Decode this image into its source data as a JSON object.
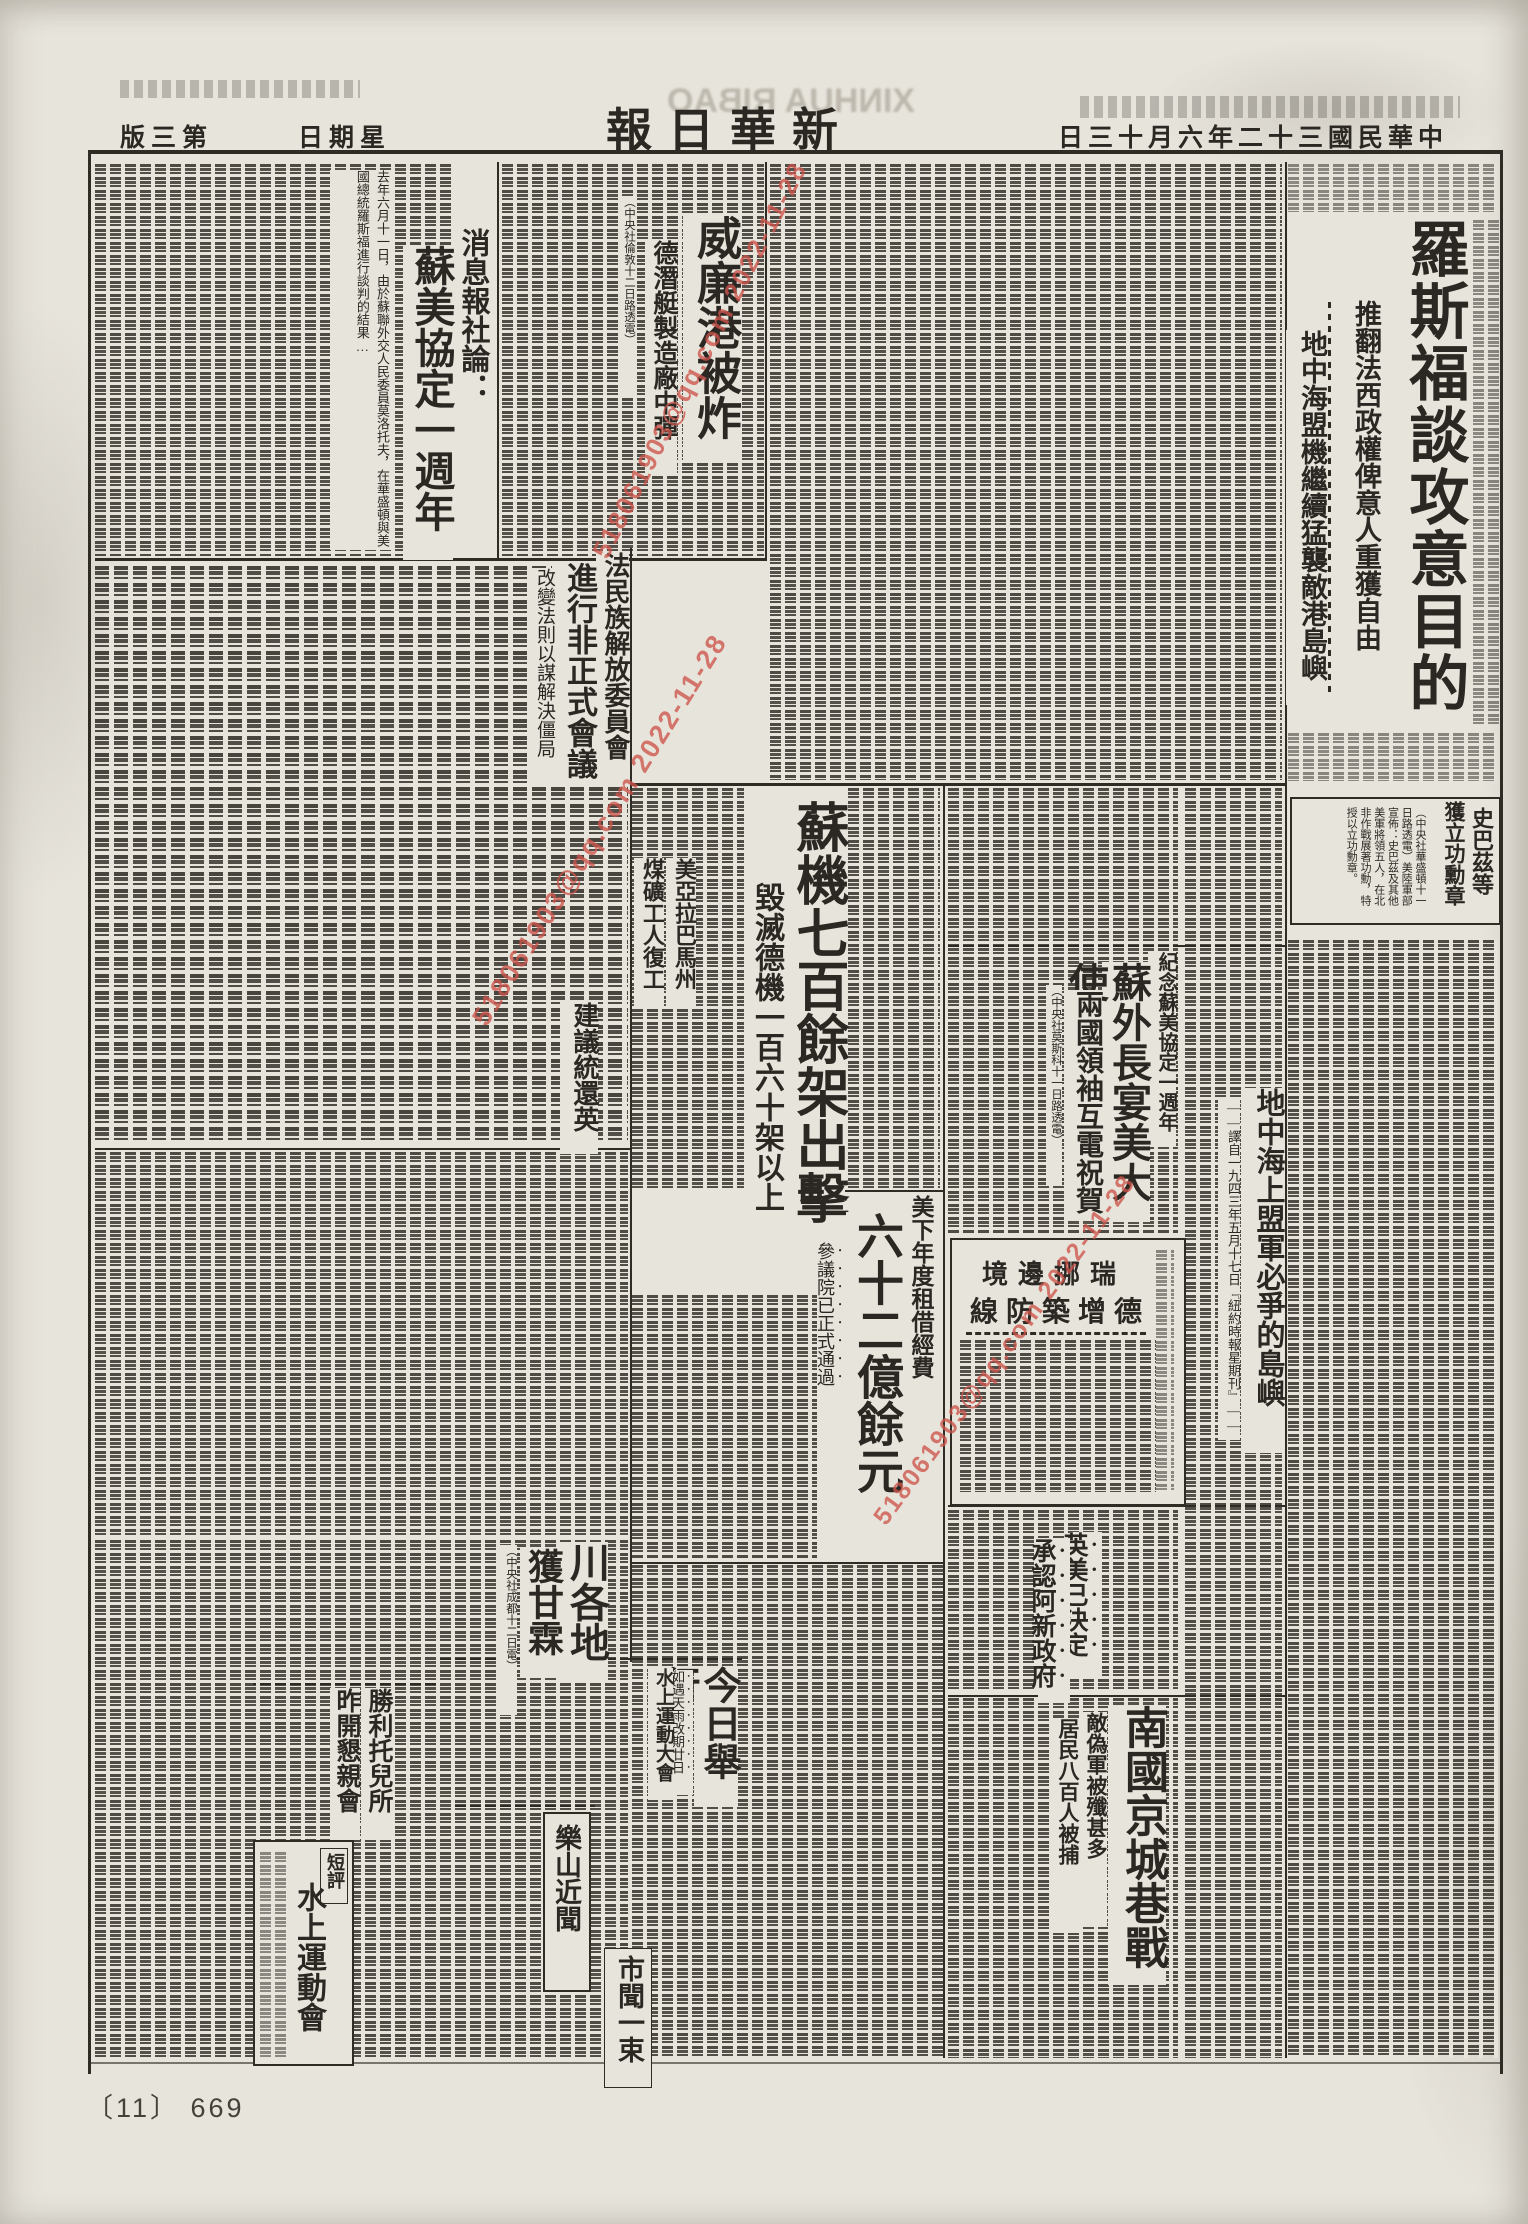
{
  "page": {
    "footer_mark": "〔11〕 669",
    "ghost_print": "XINHUA RIBAO",
    "paper_color": "#e7e4dc",
    "ink_color": "#2b2823"
  },
  "watermark": {
    "text": "518061903@qq.com 2022-11-28",
    "color": "#cd554c"
  },
  "masthead": {
    "title": "新華日報",
    "date": "中華民國三十二年六月十三日",
    "weekday": "星期日",
    "edition": "第三版"
  },
  "articles": {
    "roosevelt": {
      "headline": "羅斯福談攻意目的",
      "deck_right": "推翻法西政權俾意人重獲自由",
      "deck_left": "地中海盟機繼續猛襲敵港島嶼"
    },
    "wilhelmshaven": {
      "headline": "威廉港被炸",
      "deck": "德潛艇製造廠中彈",
      "byline": "（中央社倫敦十二日路透電）"
    },
    "editorial": {
      "kicker": "消息報社論：",
      "title": "蘇美協定一週年",
      "lead": "去年六月十一日，由於蘇聯外交人民委員莫洛托夫，在華盛頓與美國總統羅斯福進行談判的結果…"
    },
    "french_committee": {
      "kicker": "法民族解放委員會",
      "headline": "進行非正式會議",
      "deck": "改變法則以謀解決僵局"
    },
    "soviet_planes": {
      "headline": "蘇機七百餘架出擊",
      "deck": "毀滅德機一百六十架以上"
    },
    "spaatz": {
      "headline_right": "史巴茲等",
      "headline_left": "獲立功勳章",
      "body": "（中央社華盛頓十一日路透電）美陸軍部宣佈：史巴茲及其他美軍將領五人，在北非作戰展著功勳，特授以立功勳章。"
    },
    "soviet_us_anniversary": {
      "kicker": "紀念蘇美協定一週年",
      "headline": "蘇外長宴美大使",
      "deck": "兩國領袖互電祝賀",
      "byline": "（中央社莫斯科十一日路透電）"
    },
    "mediterranean": {
      "headline": "地中海上盟軍必爭的島嶼",
      "note": "——譯自一九四三年五月十七日『紐約時報星期刊』——"
    },
    "sweden_norway": {
      "kicker": "瑞挪邊境",
      "headline": "德增築防線"
    },
    "lend_lease": {
      "kicker": "美下年度租借經費",
      "headline": "六十二億餘元",
      "deck": "參議院已正式通過"
    },
    "recognize_gov": {
      "headline_right": "英美已決定",
      "headline_left": "承認阿新政府"
    },
    "nanjing": {
      "headline": "南國京城巷戰",
      "deck_right": "敵偽軍被殲甚多",
      "deck_left": "居民八百人被捕"
    },
    "alabama": {
      "headline_right": "美亞拉巴馬州",
      "headline_left": "煤礦工人復工"
    },
    "burma": {
      "headline": "建議統還英"
    },
    "sichuan_rain": {
      "headline_right": "川各地",
      "headline_left": "獲甘霖",
      "byline": "（中央社成都十二日電）"
    },
    "water_sports": {
      "headline": "今日舉行",
      "note": "如遇天雨改期廿日",
      "kicker": "水上運動大會"
    },
    "leshan": {
      "title": "樂山近聞"
    },
    "nursery": {
      "headline_right": "勝利托兒所",
      "headline_left": "昨開懇親會"
    },
    "commentary": {
      "label": "短評",
      "title": "水上運動會"
    },
    "city_news": {
      "title": "市聞一束"
    }
  }
}
